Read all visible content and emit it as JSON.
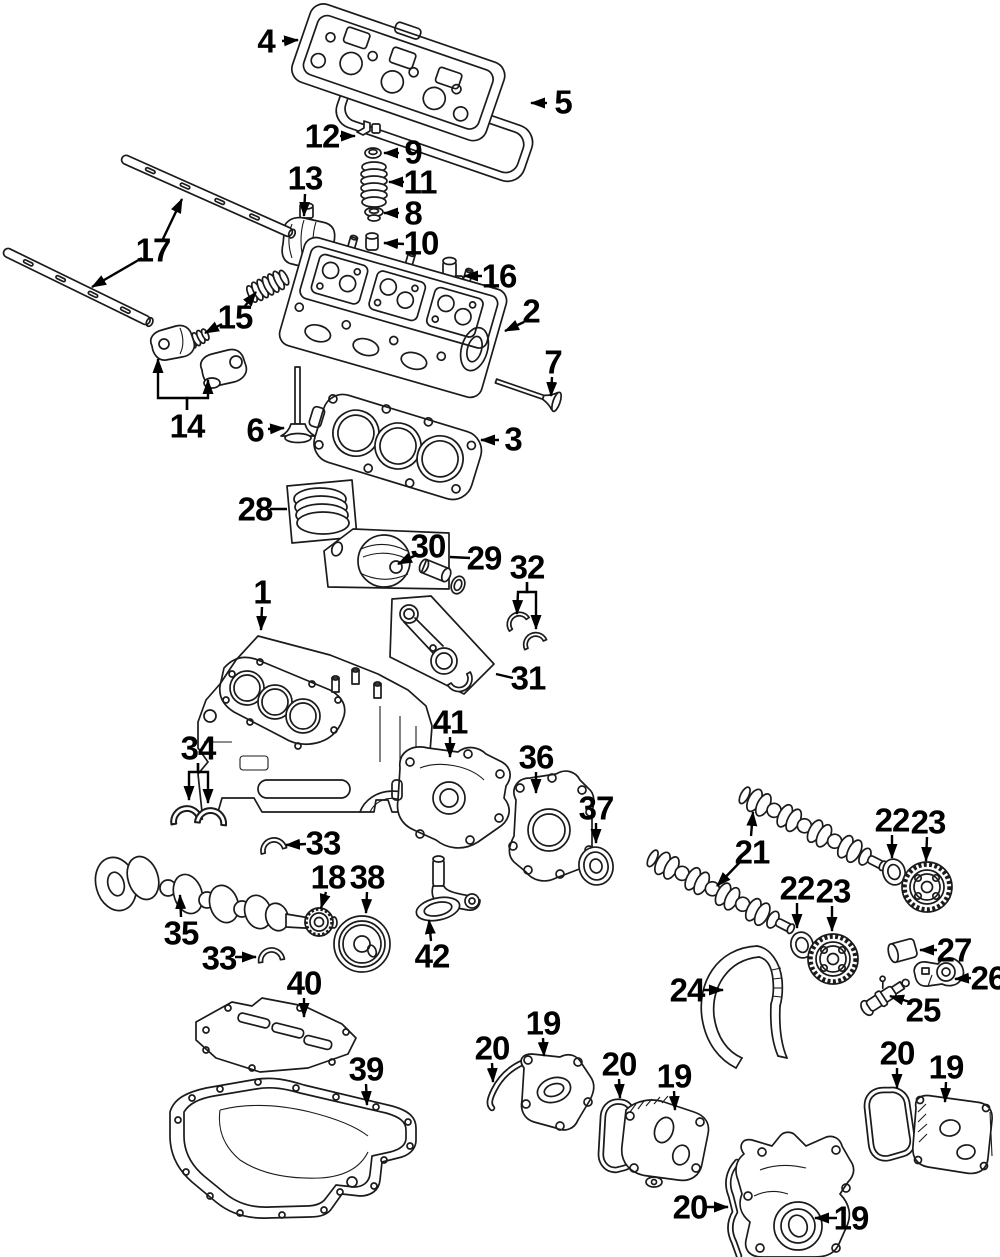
{
  "canvas": {
    "width": 1000,
    "height": 1257,
    "background": "#ffffff",
    "line_color": "#1b1b1b",
    "label_color": "#000000",
    "label_font_size": 33
  },
  "labels": [
    {
      "text": "4",
      "x": 266,
      "y": 41,
      "leaders": [
        {
          "points": [
            [
              282,
              41
            ],
            [
              298,
              40
            ]
          ],
          "arrow": true
        }
      ]
    },
    {
      "text": "5",
      "x": 563,
      "y": 102,
      "leaders": [
        {
          "points": [
            [
              547,
              103
            ],
            [
              531,
              103
            ]
          ],
          "arrow": true
        }
      ]
    },
    {
      "text": "12",
      "x": 322,
      "y": 136,
      "leaders": [
        {
          "points": [
            [
              340,
              136
            ],
            [
              355,
              136
            ]
          ],
          "arrow": true
        }
      ]
    },
    {
      "text": "9",
      "x": 413,
      "y": 152,
      "leaders": [
        {
          "points": [
            [
              399,
              153
            ],
            [
              384,
              153
            ]
          ],
          "arrow": true
        }
      ]
    },
    {
      "text": "11",
      "x": 420,
      "y": 182,
      "leaders": [
        {
          "points": [
            [
              404,
              182
            ],
            [
              389,
              182
            ]
          ],
          "arrow": true
        }
      ]
    },
    {
      "text": "8",
      "x": 413,
      "y": 213,
      "leaders": [
        {
          "points": [
            [
              399,
              213
            ],
            [
              384,
              213
            ]
          ],
          "arrow": true
        }
      ]
    },
    {
      "text": "10",
      "x": 421,
      "y": 243,
      "leaders": [
        {
          "points": [
            [
              404,
              244
            ],
            [
              384,
              243
            ]
          ],
          "arrow": true
        }
      ]
    },
    {
      "text": "13",
      "x": 305,
      "y": 178,
      "leaders": [
        {
          "points": [
            [
              305,
              194
            ],
            [
              304,
              216
            ]
          ],
          "arrow": true
        }
      ]
    },
    {
      "text": "16",
      "x": 499,
      "y": 276,
      "leaders": [
        {
          "points": [
            [
              482,
              276
            ],
            [
              464,
              276
            ]
          ],
          "arrow": true
        }
      ]
    },
    {
      "text": "17",
      "x": 153,
      "y": 250,
      "leaders": [
        {
          "points": [
            [
              162,
              241
            ],
            [
              182,
              199
            ]
          ],
          "arrow": true
        },
        {
          "points": [
            [
              142,
              258
            ],
            [
              92,
              287
            ]
          ],
          "arrow": true
        }
      ]
    },
    {
      "text": "15",
      "x": 235,
      "y": 317,
      "leaders": [
        {
          "points": [
            [
              245,
              306
            ],
            [
              256,
              292
            ]
          ],
          "arrow": true
        },
        {
          "points": [
            [
              222,
              324
            ],
            [
              205,
              333
            ]
          ],
          "arrow": true
        }
      ]
    },
    {
      "text": "14",
      "x": 187,
      "y": 426,
      "leaders": [
        {
          "points": [
            [
              187,
              410
            ],
            [
              187,
              398
            ],
            [
              158,
              398
            ],
            [
              158,
              359
            ]
          ],
          "arrow": true
        },
        {
          "points": [
            [
              187,
              410
            ],
            [
              187,
              398
            ],
            [
              208,
              398
            ],
            [
              208,
              380
            ]
          ],
          "arrow": true
        }
      ]
    },
    {
      "text": "6",
      "x": 255,
      "y": 430,
      "leaders": [
        {
          "points": [
            [
              268,
              429
            ],
            [
              284,
              428
            ]
          ],
          "arrow": true
        }
      ]
    },
    {
      "text": "2",
      "x": 531,
      "y": 311,
      "leaders": [
        {
          "points": [
            [
              524,
              322
            ],
            [
              505,
              331
            ]
          ],
          "arrow": true
        }
      ]
    },
    {
      "text": "7",
      "x": 553,
      "y": 362,
      "leaders": [
        {
          "points": [
            [
              552,
              377
            ],
            [
              551,
              396
            ]
          ],
          "arrow": true
        }
      ]
    },
    {
      "text": "3",
      "x": 513,
      "y": 439,
      "leaders": [
        {
          "points": [
            [
              499,
              440
            ],
            [
              481,
              440
            ]
          ],
          "arrow": true
        }
      ]
    },
    {
      "text": "28",
      "x": 255,
      "y": 509,
      "leaders": [
        {
          "points": [
            [
              270,
              509
            ],
            [
              287,
              509
            ]
          ],
          "arrow": false
        }
      ]
    },
    {
      "text": "30",
      "x": 428,
      "y": 546,
      "leaders": [
        {
          "points": [
            [
              418,
              554
            ],
            [
              398,
              564
            ]
          ],
          "arrow": true
        }
      ]
    },
    {
      "text": "29",
      "x": 484,
      "y": 558,
      "leaders": [
        {
          "points": [
            [
              470,
              558
            ],
            [
              450,
              557
            ]
          ],
          "arrow": false
        }
      ]
    },
    {
      "text": "32",
      "x": 527,
      "y": 567,
      "leaders": [
        {
          "points": [
            [
              527,
              582
            ],
            [
              527,
              592
            ],
            [
              518,
              592
            ],
            [
              517,
              614
            ]
          ],
          "arrow": true
        },
        {
          "points": [
            [
              527,
              582
            ],
            [
              527,
              592
            ],
            [
              536,
              592
            ],
            [
              536,
              629
            ]
          ],
          "arrow": true
        }
      ]
    },
    {
      "text": "31",
      "x": 528,
      "y": 678,
      "leaders": [
        {
          "points": [
            [
              513,
              678
            ],
            [
              496,
              674
            ]
          ],
          "arrow": false
        }
      ]
    },
    {
      "text": "1",
      "x": 262,
      "y": 592,
      "leaders": [
        {
          "points": [
            [
              262,
              607
            ],
            [
              261,
              630
            ]
          ],
          "arrow": true
        }
      ]
    },
    {
      "text": "41",
      "x": 450,
      "y": 722,
      "leaders": [
        {
          "points": [
            [
              450,
              737
            ],
            [
              450,
              757
            ]
          ],
          "arrow": true
        }
      ]
    },
    {
      "text": "34",
      "x": 198,
      "y": 748,
      "leaders": [
        {
          "points": [
            [
              198,
              763
            ],
            [
              198,
              772
            ],
            [
              189,
              772
            ],
            [
              189,
              800
            ]
          ],
          "arrow": true
        },
        {
          "points": [
            [
              198,
              763
            ],
            [
              198,
              772
            ],
            [
              208,
              772
            ],
            [
              208,
              803
            ]
          ],
          "arrow": true
        }
      ]
    },
    {
      "text": "36",
      "x": 536,
      "y": 757,
      "leaders": [
        {
          "points": [
            [
              536,
              772
            ],
            [
              536,
              793
            ]
          ],
          "arrow": true
        }
      ]
    },
    {
      "text": "37",
      "x": 596,
      "y": 808,
      "leaders": [
        {
          "points": [
            [
              596,
              823
            ],
            [
              596,
              843
            ]
          ],
          "arrow": true
        }
      ]
    },
    {
      "text": "33",
      "x": 323,
      "y": 843,
      "leaders": [
        {
          "points": [
            [
              306,
              844
            ],
            [
              286,
              845
            ]
          ],
          "arrow": true
        }
      ]
    },
    {
      "text": "18",
      "x": 328,
      "y": 877,
      "leaders": [
        {
          "points": [
            [
              326,
              892
            ],
            [
              321,
              908
            ]
          ],
          "arrow": true
        }
      ]
    },
    {
      "text": "38",
      "x": 367,
      "y": 877,
      "leaders": [
        {
          "points": [
            [
              367,
              892
            ],
            [
              366,
              913
            ]
          ],
          "arrow": true
        }
      ]
    },
    {
      "text": "35",
      "x": 181,
      "y": 933,
      "leaders": [
        {
          "points": [
            [
              181,
              917
            ],
            [
              180,
              895
            ]
          ],
          "arrow": true
        }
      ]
    },
    {
      "text": "33",
      "x": 219,
      "y": 958,
      "leaders": [
        {
          "points": [
            [
              235,
              957
            ],
            [
              256,
              957
            ]
          ],
          "arrow": true
        }
      ]
    },
    {
      "text": "42",
      "x": 432,
      "y": 956,
      "leaders": [
        {
          "points": [
            [
              431,
              941
            ],
            [
              429,
              920
            ]
          ],
          "arrow": true
        }
      ]
    },
    {
      "text": "40",
      "x": 304,
      "y": 983,
      "leaders": [
        {
          "points": [
            [
              304,
              998
            ],
            [
              304,
              1017
            ]
          ],
          "arrow": true
        }
      ]
    },
    {
      "text": "39",
      "x": 366,
      "y": 1069,
      "leaders": [
        {
          "points": [
            [
              366,
              1084
            ],
            [
              367,
              1105
            ]
          ],
          "arrow": true
        }
      ]
    },
    {
      "text": "21",
      "x": 752,
      "y": 852,
      "leaders": [
        {
          "points": [
            [
              751,
              836
            ],
            [
              753,
              812
            ]
          ],
          "arrow": true
        },
        {
          "points": [
            [
              740,
              862
            ],
            [
              717,
              886
            ]
          ],
          "arrow": true
        }
      ]
    },
    {
      "text": "22",
      "x": 892,
      "y": 820,
      "leaders": [
        {
          "points": [
            [
              892,
              835
            ],
            [
              892,
              858
            ]
          ],
          "arrow": true
        }
      ]
    },
    {
      "text": "23",
      "x": 928,
      "y": 822,
      "leaders": [
        {
          "points": [
            [
              927,
              837
            ],
            [
              926,
              861
            ]
          ],
          "arrow": true
        }
      ]
    },
    {
      "text": "22",
      "x": 797,
      "y": 888,
      "leaders": [
        {
          "points": [
            [
              797,
              903
            ],
            [
              797,
              928
            ]
          ],
          "arrow": true
        }
      ]
    },
    {
      "text": "23",
      "x": 833,
      "y": 891,
      "leaders": [
        {
          "points": [
            [
              832,
              906
            ],
            [
              832,
              931
            ]
          ],
          "arrow": true
        }
      ]
    },
    {
      "text": "24",
      "x": 687,
      "y": 990,
      "leaders": [
        {
          "points": [
            [
              703,
              990
            ],
            [
              723,
              990
            ]
          ],
          "arrow": true
        }
      ]
    },
    {
      "text": "25",
      "x": 923,
      "y": 1010,
      "leaders": [
        {
          "points": [
            [
              910,
              1002
            ],
            [
              890,
              996
            ]
          ],
          "arrow": true
        }
      ]
    },
    {
      "text": "27",
      "x": 954,
      "y": 950,
      "leaders": [
        {
          "points": [
            [
              937,
              950
            ],
            [
              920,
              950
            ]
          ],
          "arrow": true
        }
      ]
    },
    {
      "text": "26",
      "x": 988,
      "y": 978,
      "leaders": [
        {
          "points": [
            [
              971,
              978
            ],
            [
              955,
              979
            ]
          ],
          "arrow": true
        }
      ]
    },
    {
      "text": "19",
      "x": 543,
      "y": 1023,
      "leaders": [
        {
          "points": [
            [
              543,
              1038
            ],
            [
              544,
              1056
            ]
          ],
          "arrow": true
        }
      ]
    },
    {
      "text": "20",
      "x": 492,
      "y": 1048,
      "leaders": [
        {
          "points": [
            [
              492,
              1063
            ],
            [
              493,
              1082
            ]
          ],
          "arrow": true
        }
      ]
    },
    {
      "text": "20",
      "x": 619,
      "y": 1064,
      "leaders": [
        {
          "points": [
            [
              619,
              1079
            ],
            [
              620,
              1098
            ]
          ],
          "arrow": true
        }
      ]
    },
    {
      "text": "19",
      "x": 674,
      "y": 1076,
      "leaders": [
        {
          "points": [
            [
              674,
              1091
            ],
            [
              675,
              1110
            ]
          ],
          "arrow": true
        }
      ]
    },
    {
      "text": "20",
      "x": 897,
      "y": 1053,
      "leaders": [
        {
          "points": [
            [
              897,
              1068
            ],
            [
              897,
              1088
            ]
          ],
          "arrow": true
        }
      ]
    },
    {
      "text": "19",
      "x": 946,
      "y": 1067,
      "leaders": [
        {
          "points": [
            [
              946,
              1082
            ],
            [
              945,
              1102
            ]
          ],
          "arrow": true
        }
      ]
    },
    {
      "text": "20",
      "x": 690,
      "y": 1207,
      "leaders": [
        {
          "points": [
            [
              704,
              1207
            ],
            [
              728,
              1207
            ]
          ],
          "arrow": true
        }
      ]
    },
    {
      "text": "19",
      "x": 851,
      "y": 1218,
      "leaders": [
        {
          "points": [
            [
              837,
              1218
            ],
            [
              815,
              1218
            ]
          ],
          "arrow": true
        }
      ]
    }
  ]
}
